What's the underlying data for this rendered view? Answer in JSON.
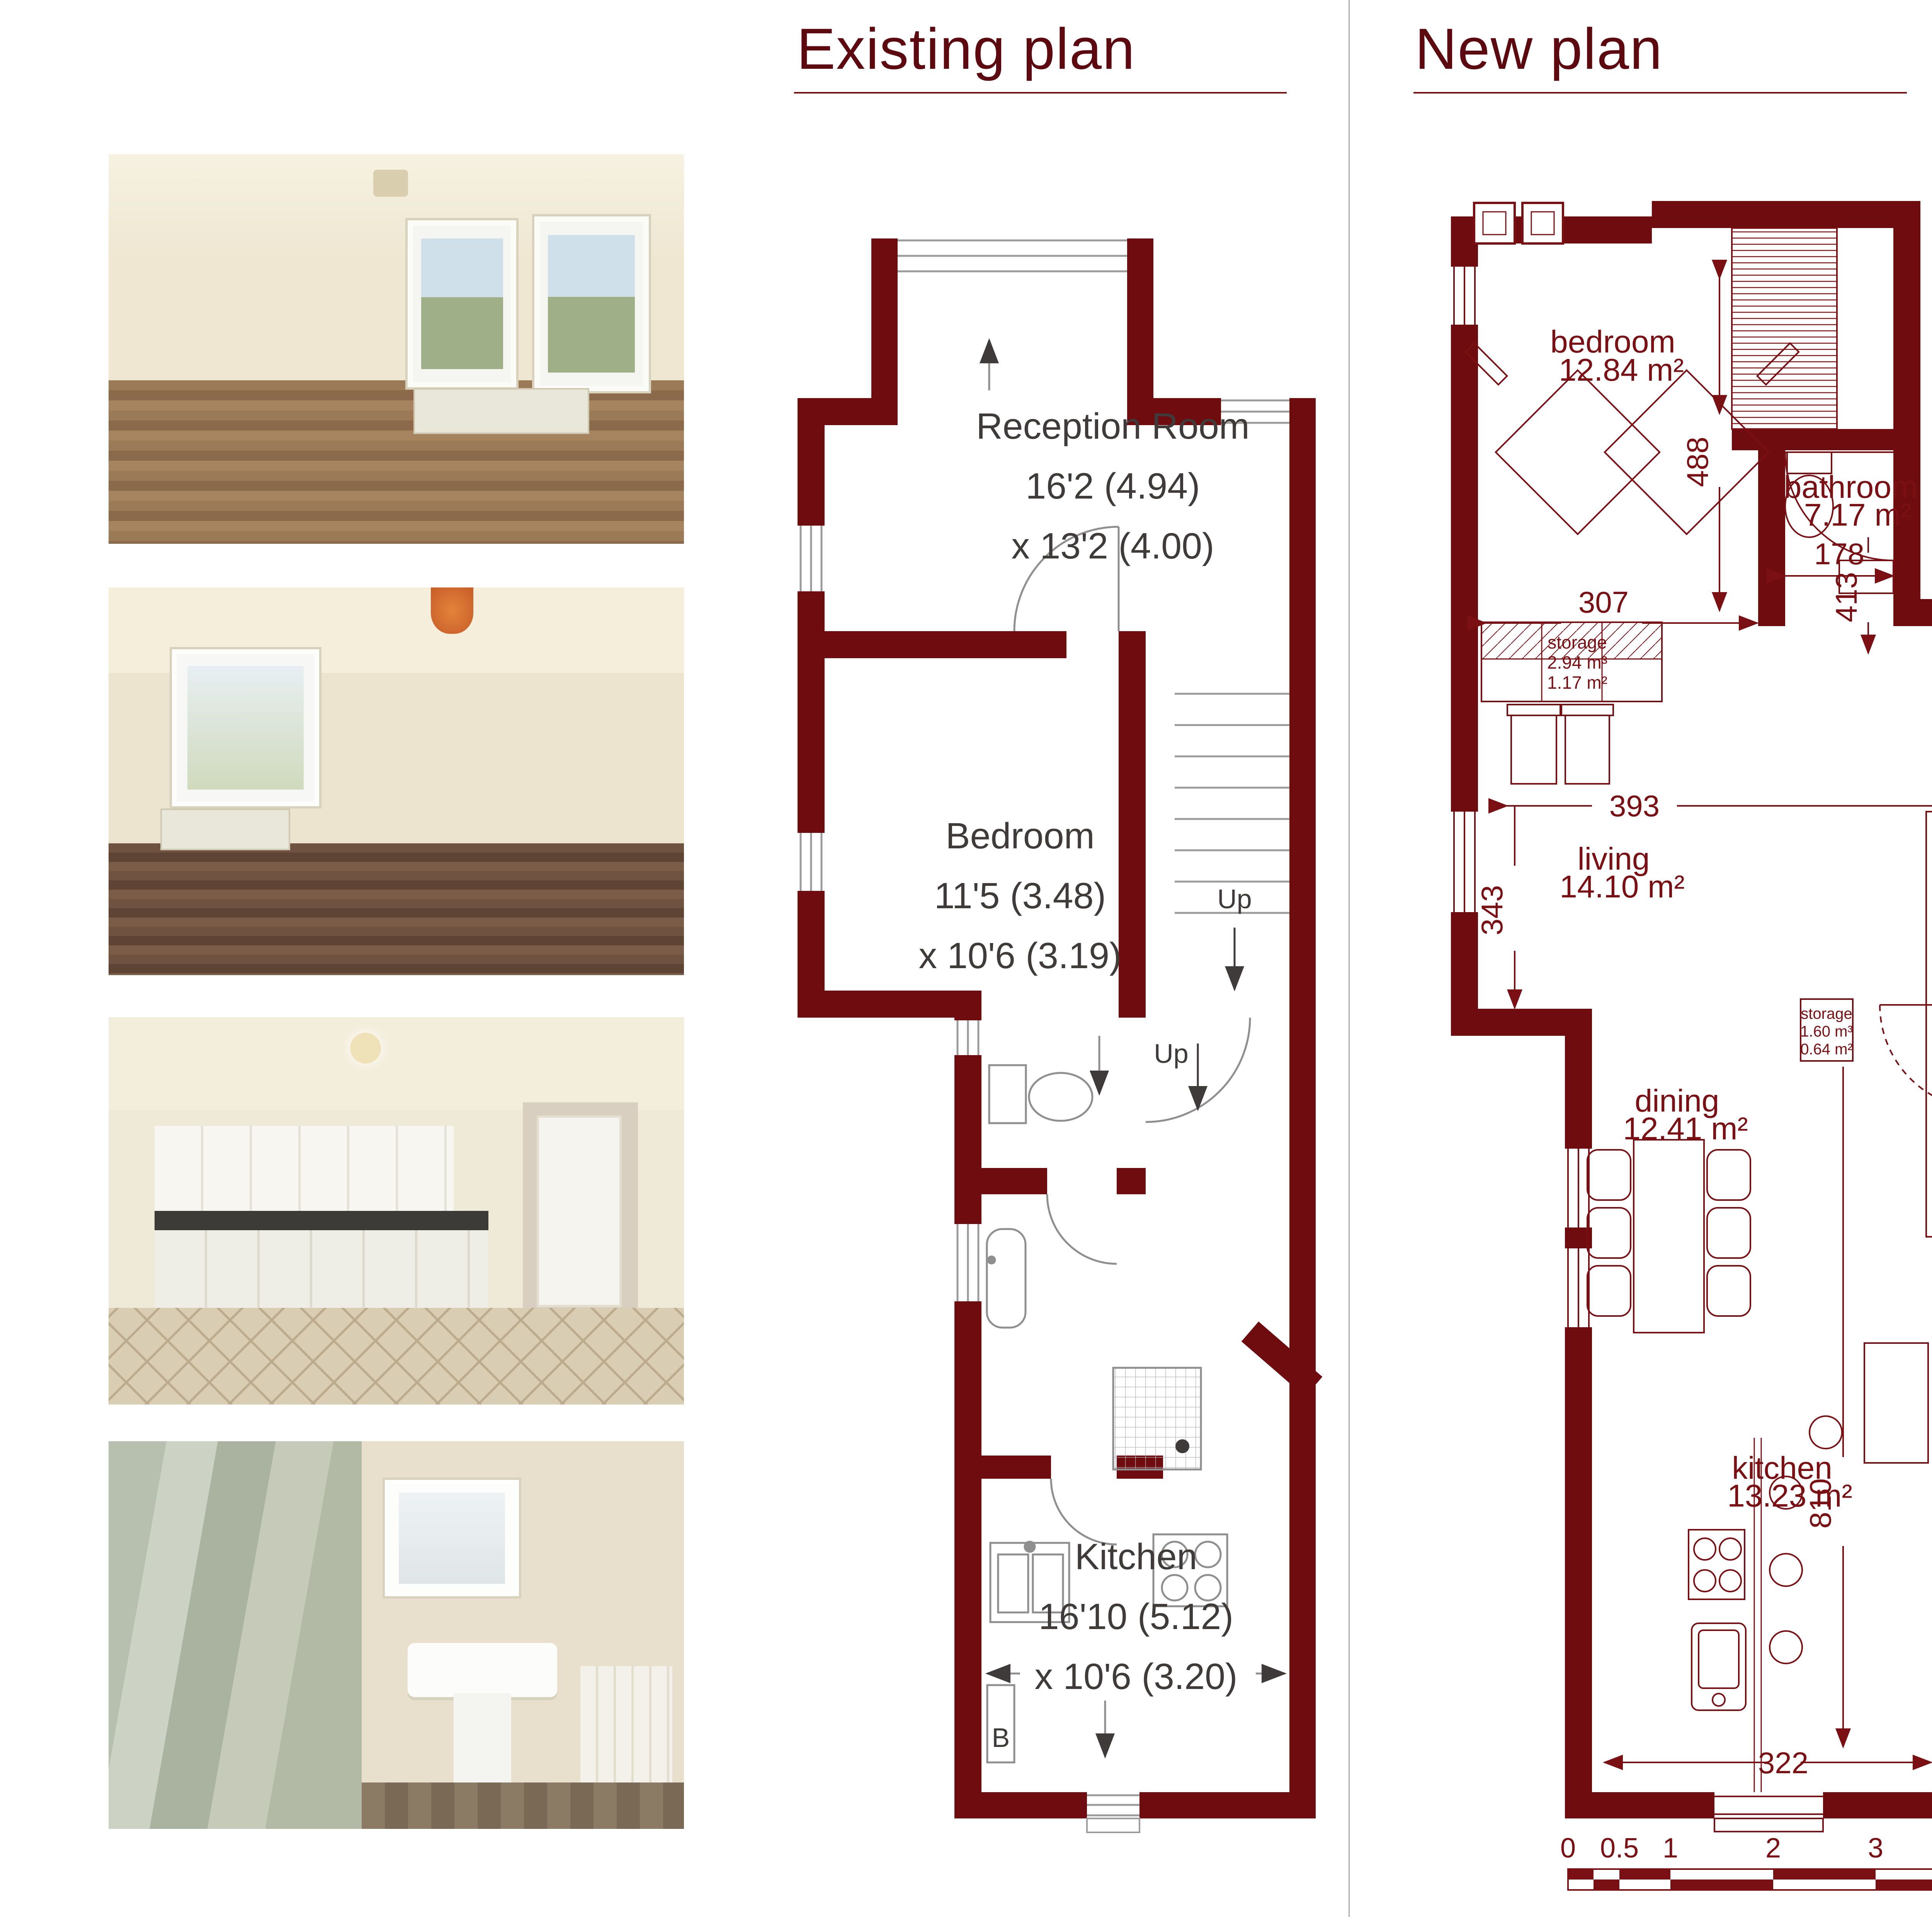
{
  "titles": {
    "existing": "Existing plan",
    "new": "New plan"
  },
  "existing_plan": {
    "rooms": [
      {
        "name": "Reception Room",
        "line2": "16'2 (4.94)",
        "line3": "x 13'2 (4.00)"
      },
      {
        "name": "Bedroom",
        "line2": "11'5 (3.48)",
        "line3": "x 10'6 (3.19)"
      },
      {
        "name": "Kitchen",
        "line2": "16'10 (5.12)",
        "line3": "x 10'6 (3.20)"
      }
    ],
    "up_label_1": "Up",
    "up_label_2": "Up",
    "boiler_label": "B"
  },
  "new_plan": {
    "rooms": [
      {
        "name": "bedroom",
        "area": "12.84 m²"
      },
      {
        "name": "bathroom",
        "area": "7.17 m²"
      },
      {
        "name": "living",
        "area": "14.10 m²"
      },
      {
        "name": "dining",
        "area": "12.41 m²"
      },
      {
        "name": "kitchen",
        "area": "13.23 m²"
      }
    ],
    "storage_labels": [
      {
        "name": "storage",
        "volume": "2.94 m³",
        "area": "1.17 m²"
      },
      {
        "name": "storage",
        "volume": "1.60 m³",
        "area": "0.64 m²"
      },
      {
        "name": "storage",
        "volume": "0.91 m³",
        "area": "0.36 m²"
      }
    ],
    "dimensions": {
      "d307": "307",
      "d488": "488",
      "d178": "178",
      "d413": "413",
      "d393": "393",
      "d343": "343",
      "d810": "810",
      "d322": "322"
    }
  },
  "scale_bar": {
    "labels": [
      "0",
      "0.5",
      "1",
      "2",
      "3",
      "4",
      "5"
    ]
  },
  "colors": {
    "wall": "#6e0c10",
    "plan_accent": "#7a1013",
    "label_dark": "#3e3b3a",
    "title": "#5c0a10"
  }
}
